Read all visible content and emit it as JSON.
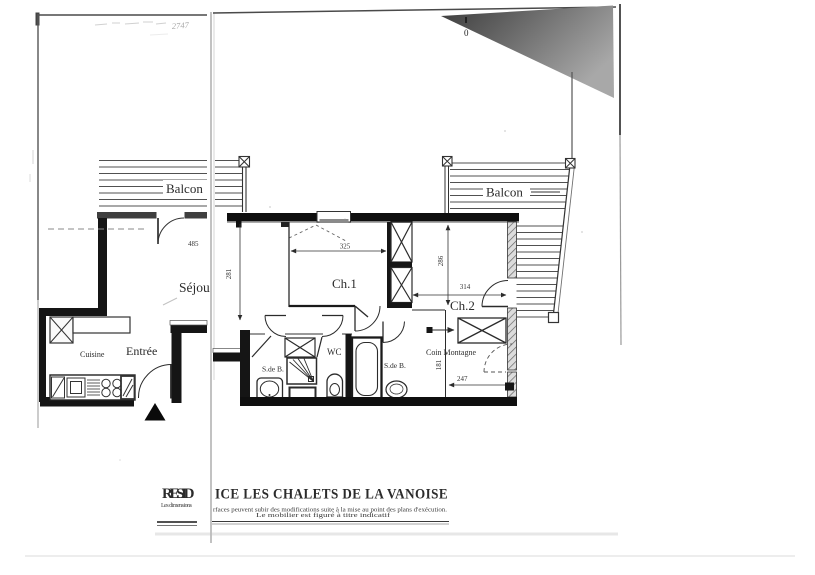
{
  "annotations": {
    "pencil_note": "2747",
    "zero_mark": "0"
  },
  "plan": {
    "balcony_left": {
      "label": "Balcon"
    },
    "balcony_right": {
      "label": "Balcon"
    },
    "rooms": {
      "sejour": "Séjour",
      "entree": "Entrée",
      "cuisine": "Cuisine",
      "ch1": "Ch.1",
      "ch2": "Ch.2",
      "wc": "WC",
      "sdb1": "S.de B.",
      "sdb2": "S.de B.",
      "coin_montagne": "Coin Montagne"
    },
    "dims": {
      "d485": "485",
      "d281": "281",
      "d325": "325",
      "d286": "286",
      "d314": "314",
      "d181": "181",
      "d247": "247"
    }
  },
  "title_block": {
    "title_left": "RESID",
    "title_right": "ICE LES CHALETS DE LA VANOISE",
    "sub_left": "Les dimensions",
    "caption1": "rfaces peuvent subir des modifications suite à la mise au point des plans d'exécution.",
    "caption2": "Le mobilier est figuré à titre indicatif"
  },
  "colors": {
    "ink": "#2b2b2b",
    "wall_fill": "#141414",
    "paper": "#ffffff",
    "scan_shadow": "#4a4a4a"
  }
}
